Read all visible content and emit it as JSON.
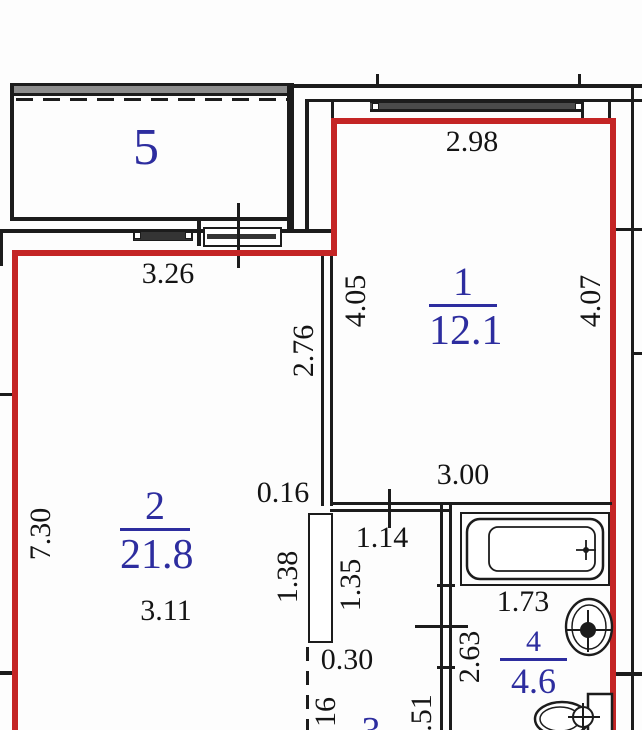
{
  "title": "apartment floor plan",
  "colors": {
    "outline_red": "#c42525",
    "wall_black": "#1c1c1c",
    "room_label_blue": "#2d2d9f"
  },
  "rooms": {
    "balcony": {
      "number": "5"
    },
    "room1": {
      "number": "1",
      "area": "12.1"
    },
    "room2": {
      "number": "2",
      "area": "21.8"
    },
    "bathroom": {
      "number": "4",
      "area": "4.6"
    },
    "room3": {
      "number": "3"
    }
  },
  "dimensions": {
    "balcony_width": "3.26",
    "room1_top_width": "2.98",
    "room1_left_height": "4.05",
    "room1_right_height": "4.07",
    "room1_bottom_width": "3.00",
    "room2_left_height": "7.30",
    "room2_wall_upper": "2.76",
    "room2_bottom_width": "3.11",
    "wall_offset": "0.16",
    "hall_top_width": "1.14",
    "hall_pier_length": "1.35",
    "room2_pier_length": "1.38",
    "hall_gap": "0.30",
    "bath_top_width": "1.73",
    "bath_right_height": "2.63",
    "partial_bottom_left": "16",
    "partial_bottom_mid": ".51"
  },
  "fixtures": {
    "bathtub": "bathtub-icon",
    "sink": "sink-icon",
    "toilet": "toilet-icon"
  }
}
